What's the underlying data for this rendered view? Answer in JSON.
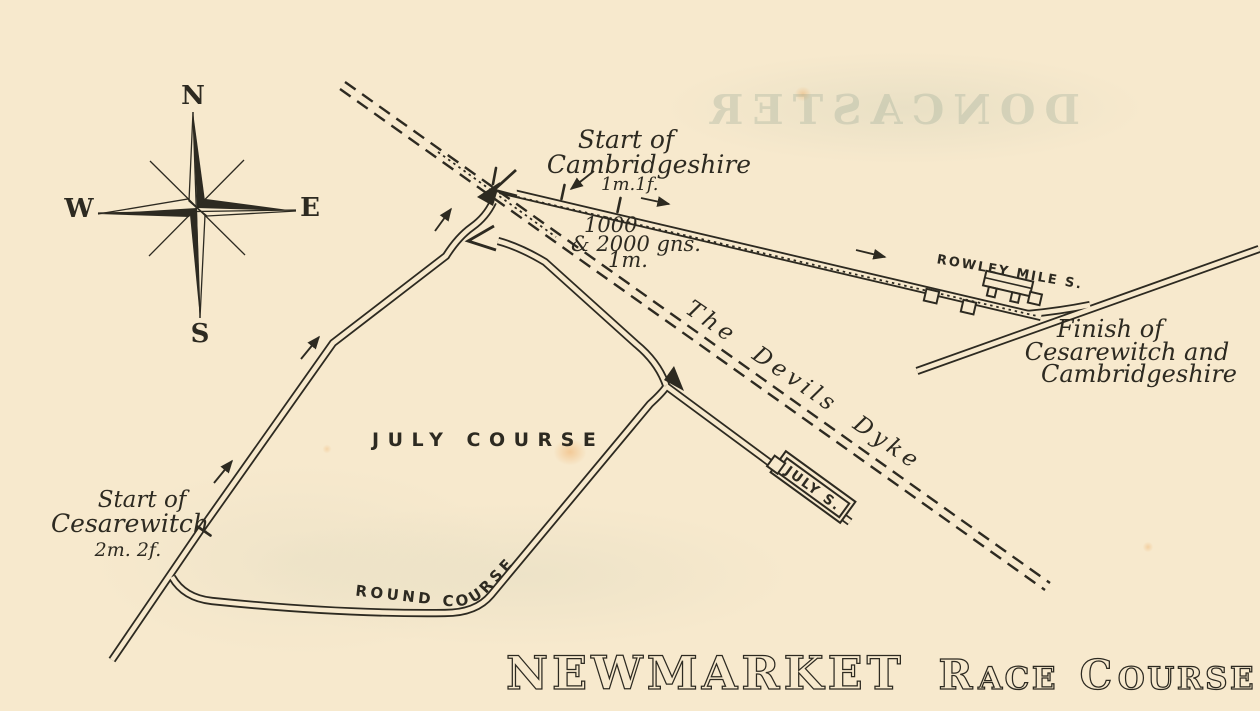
{
  "colors": {
    "paper": "#f7e9cd",
    "ink": "#2d2a21",
    "showthrough": "#7d9686"
  },
  "title": {
    "word1": "NEWMARKET",
    "word2_cap": "R",
    "word2_rest": "ACE",
    "word3_cap": "C",
    "word3_rest": "OURSE"
  },
  "compass": {
    "n": "N",
    "e": "E",
    "s": "S",
    "w": "W"
  },
  "ghost_showthrough": "DONCASTER",
  "labels": {
    "july_course": "JULY COURSE",
    "round_course": "ROUND COURSE",
    "devils_dyke": "The Devils Dyke",
    "rowley_stand": "ROWLEY MILE S.",
    "july_stand": "JULY S.",
    "cambridgeshire_start_1": "Start of",
    "cambridgeshire_start_2": "Cambridgeshire",
    "cambridgeshire_start_dist": "1m.1f.",
    "guineas_1": "1000",
    "guineas_2": "& 2000 gns.",
    "guineas_dist": "1m.",
    "cesarewitch_start_1": "Start of",
    "cesarewitch_start_2": "Cesarewitch",
    "cesarewitch_start_dist": "2m. 2f.",
    "finish_1": "Finish of",
    "finish_2": "Cesarewitch and",
    "finish_3": "Cambridgeshire"
  }
}
